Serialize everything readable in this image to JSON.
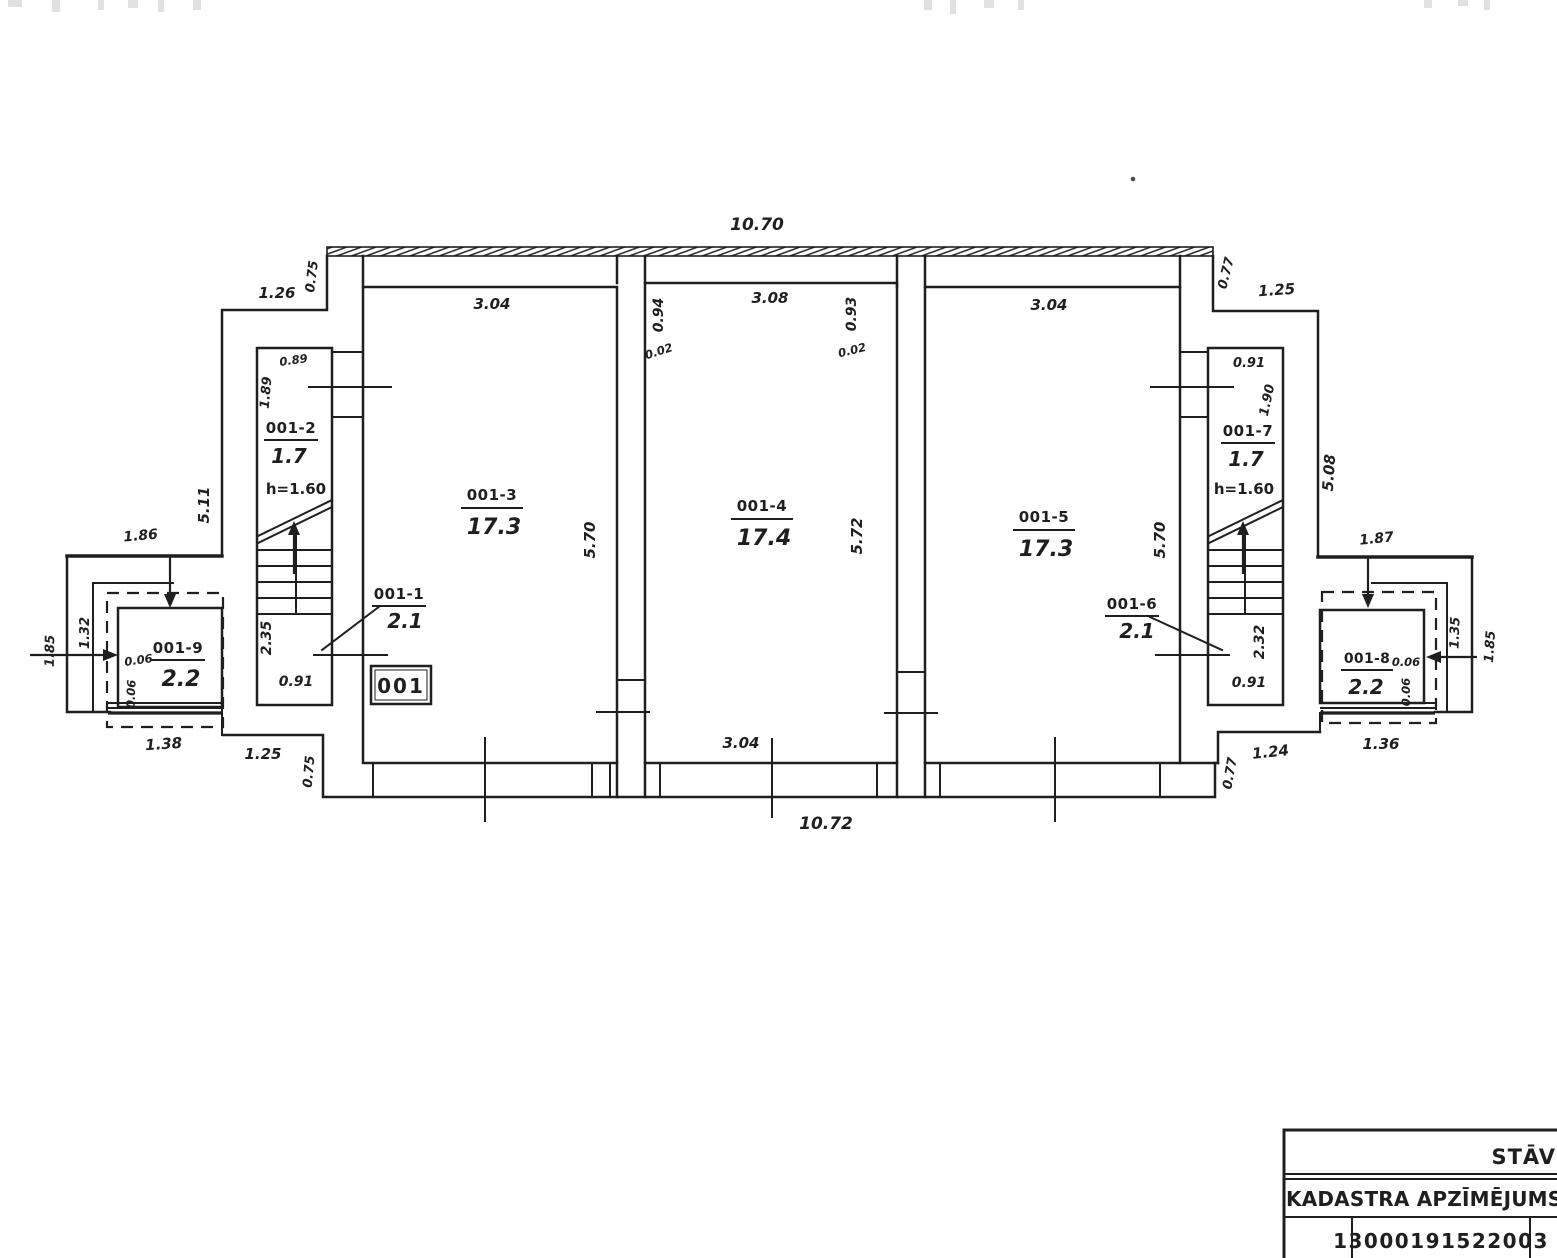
{
  "document": {
    "type": "cadastral floor plan (scanned)",
    "ink_color": "#1f1f1f",
    "faded_label_color": "#8d8d8d",
    "background": "#ffffff"
  },
  "plan": {
    "unit_label": "001",
    "rooms": {
      "r1": {
        "id": "001-1",
        "area": "2.1"
      },
      "r2": {
        "id": "001-2",
        "area": "1.7",
        "note": "h=1.60"
      },
      "r3": {
        "id": "001-3",
        "area": "17.3"
      },
      "r4": {
        "id": "001-4",
        "area": "17.4"
      },
      "r5": {
        "id": "001-5",
        "area": "17.3"
      },
      "r6": {
        "id": "001-6",
        "area": "2.1"
      },
      "r7": {
        "id": "001-7",
        "area": "1.7",
        "note": "h=1.60"
      },
      "r8": {
        "id": "001-8",
        "area": "2.2"
      },
      "r9": {
        "id": "001-9",
        "area": "2.2"
      }
    },
    "dims": {
      "top_total": "10.70",
      "top_left_offset": "1.26",
      "top_left_step": "0.75",
      "top_right_step": "0.77",
      "top_right_offset": "1.25",
      "r3_top": "3.04",
      "r4_jamb_left": "0.94",
      "r4_gap_left": "0.02",
      "r4_top": "3.08",
      "r4_jamb_right": "0.93",
      "r4_gap_right": "0.02",
      "r5_top": "3.04",
      "left_side": "5.11",
      "left_stair_top": "0.89",
      "left_stair_side": "1.89",
      "r3_side": "5.70",
      "r4_side": "5.72",
      "r5_side": "5.70",
      "right_stair_top": "0.91",
      "right_stair_side": "1.90",
      "right_side": "5.08",
      "left_porch_top": "1.86",
      "left_porch_inner": "1.32",
      "left_porch_outer": "1.85",
      "left_thk_a": "0.06",
      "left_thk_b": "0.06",
      "left_landing_side": "2.35",
      "left_landing_bottom": "0.91",
      "left_porch_bottom": "1.38",
      "bottom_left_offset": "1.25",
      "bottom_left_step": "0.75",
      "r4_bottom": "3.04",
      "bottom_total": "10.72",
      "right_landing_side": "2.32",
      "right_landing_bottom": "0.91",
      "right_porch_top": "1.87",
      "right_porch_inner": "1.35",
      "right_porch_outer": "1.85",
      "right_thk_a": "0.06",
      "right_thk_b": "0.06",
      "right_porch_bottom": "1.36",
      "bottom_right_offset": "1.24",
      "bottom_right_step": "0.77"
    }
  },
  "title_block": {
    "row1": "STĀV",
    "row2": "KADASTRA APZĪMĒJUMS",
    "row3": "13000191522003"
  }
}
